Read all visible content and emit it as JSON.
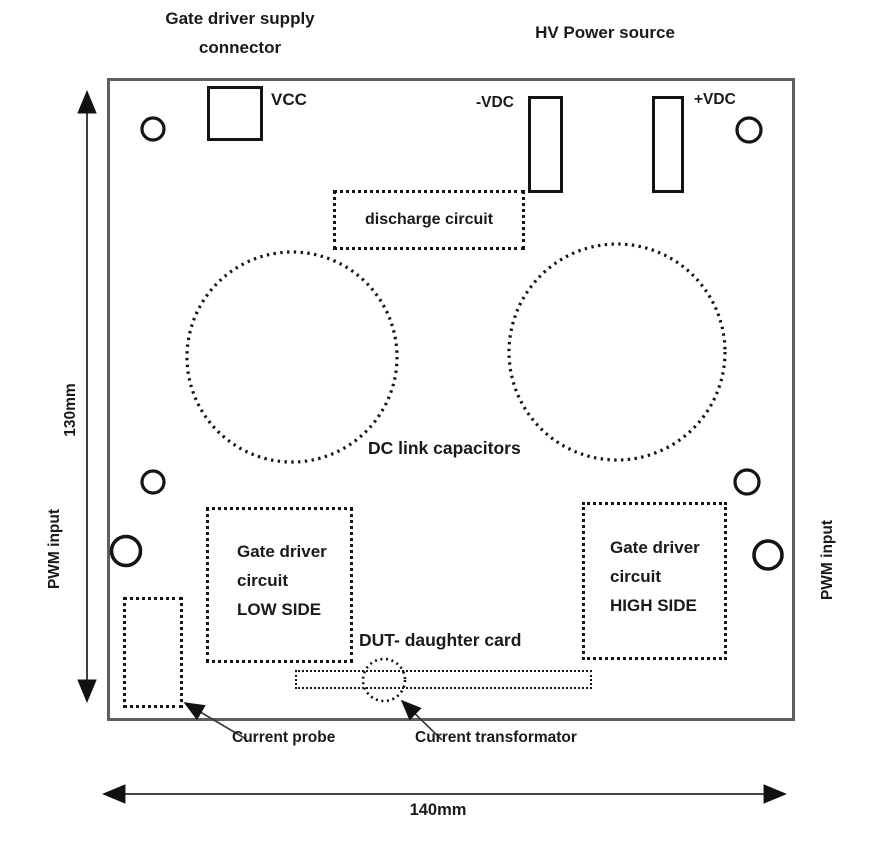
{
  "titles": {
    "gate_driver_supply_connector": "Gate driver supply connector",
    "hv_power_source": "HV Power source"
  },
  "connectors": {
    "vcc": "VCC",
    "neg_vdc": "-VDC",
    "pos_vdc": "+VDC"
  },
  "blocks": {
    "discharge_circuit": "discharge circuit",
    "dc_link_capacitors": "DC link capacitors",
    "gate_driver_low_lines": [
      "Gate driver",
      "circuit",
      "LOW SIDE"
    ],
    "gate_driver_high_lines": [
      "Gate driver",
      "circuit",
      "HIGH SIDE"
    ],
    "dut_daughter_card": "DUT- daughter card"
  },
  "annotations": {
    "current_probe": "Current probe",
    "current_transformator": "Current transformator"
  },
  "dimensions": {
    "board_height": "130mm",
    "board_width": "140mm",
    "pwm_input_left": "PWM input",
    "pwm_input_right": "PWM input"
  },
  "colors": {
    "ink": "#1a1a1a",
    "board_border": "#5f5f5f",
    "background": "#ffffff"
  }
}
